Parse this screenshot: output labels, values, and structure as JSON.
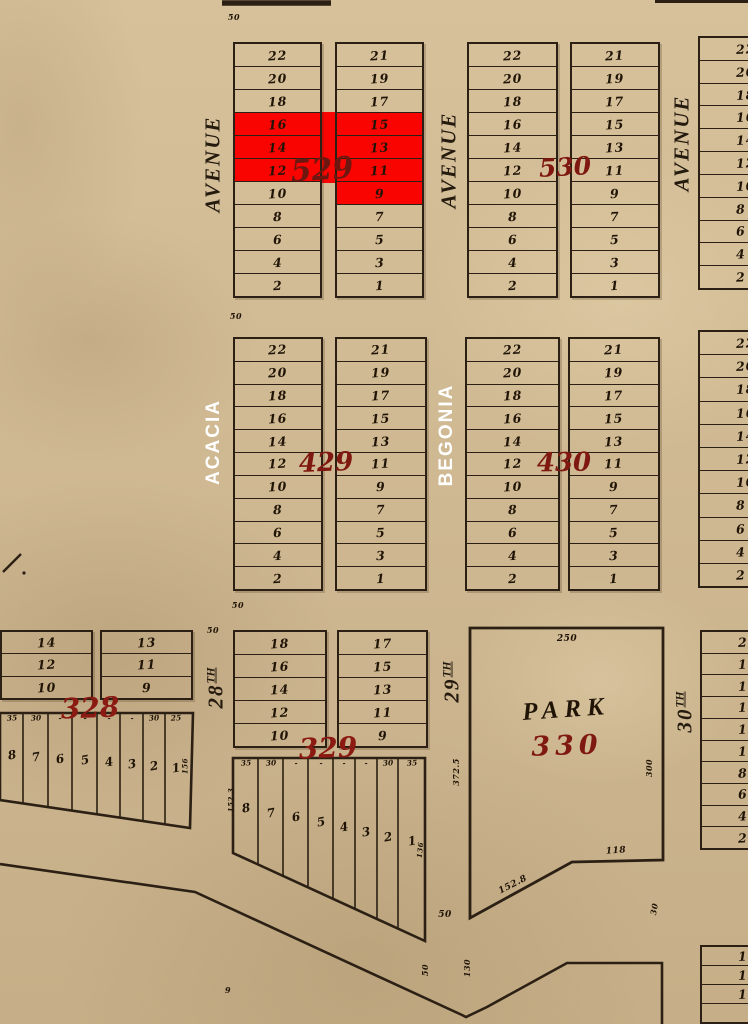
{
  "colors": {
    "background": "#d2bb93",
    "line": "#2b2013",
    "ink": "#201407",
    "highlight_red": "#f90400",
    "block_number_red": "#7e1810",
    "overlay_label_white": "#ffffff"
  },
  "blocks": {
    "b529": {
      "number": "529",
      "left_lots": [
        "22",
        "20",
        "18",
        "16",
        "14",
        "12",
        "10",
        "8",
        "6",
        "4",
        "2"
      ],
      "right_lots": [
        "21",
        "19",
        "17",
        "15",
        "13",
        "11",
        "9",
        "7",
        "5",
        "3",
        "1"
      ],
      "highlighted_left_lots": [
        "16",
        "14",
        "12"
      ],
      "highlighted_right_lots": [
        "15",
        "13",
        "11",
        "9"
      ]
    },
    "b530": {
      "number": "530",
      "left_lots": [
        "22",
        "20",
        "18",
        "16",
        "14",
        "12",
        "10",
        "8",
        "6",
        "4",
        "2"
      ],
      "right_lots": [
        "21",
        "19",
        "17",
        "15",
        "13",
        "11",
        "9",
        "7",
        "5",
        "3",
        "1"
      ],
      "highlighted_left_lots": [],
      "highlighted_right_lots": []
    },
    "b429": {
      "number": "429",
      "left_lots": [
        "22",
        "20",
        "18",
        "16",
        "14",
        "12",
        "10",
        "8",
        "6",
        "4",
        "2"
      ],
      "right_lots": [
        "21",
        "19",
        "17",
        "15",
        "13",
        "11",
        "9",
        "7",
        "5",
        "3",
        "1"
      ],
      "highlighted_left_lots": [],
      "highlighted_right_lots": []
    },
    "b430": {
      "number": "430",
      "left_lots": [
        "22",
        "20",
        "18",
        "16",
        "14",
        "12",
        "10",
        "8",
        "6",
        "4",
        "2"
      ],
      "right_lots": [
        "21",
        "19",
        "17",
        "15",
        "13",
        "11",
        "9",
        "7",
        "5",
        "3",
        "1"
      ],
      "highlighted_left_lots": [],
      "highlighted_right_lots": []
    },
    "b328": {
      "number": "328",
      "upper_left_lots": [
        "14",
        "12",
        "10"
      ],
      "upper_right_lots": [
        "13",
        "11",
        "9"
      ],
      "lower_lots": [
        "8",
        "7",
        "6",
        "5",
        "4",
        "3",
        "2",
        "1"
      ],
      "lower_dims": [
        "35",
        "30",
        "-",
        "-",
        "-",
        "-",
        "30",
        "25"
      ],
      "right_edge_dim": "156"
    },
    "b329": {
      "number": "329",
      "upper_left_lots": [
        "18",
        "16",
        "14",
        "12",
        "10"
      ],
      "upper_right_lots": [
        "17",
        "15",
        "13",
        "11",
        "9"
      ],
      "lower_lots": [
        "8",
        "7",
        "6",
        "5",
        "4",
        "3",
        "2",
        "1"
      ],
      "lower_dims": [
        "35",
        "30",
        "-",
        "-",
        "-",
        "-",
        "30",
        "35"
      ],
      "left_edge_dim": "152.3",
      "right_edge_dim": "136"
    },
    "b330": {
      "name": "PARK",
      "number": "330",
      "dim_top": "250",
      "dim_left": "372.5",
      "dim_right": "300",
      "dim_bottom": "118",
      "dim_diagonal": "152.8"
    },
    "partial_ne": {
      "lots": [
        "22",
        "20",
        "18",
        "16",
        "14",
        "12",
        "10",
        "8",
        "6",
        "4",
        "2"
      ]
    },
    "partial_e": {
      "lots": [
        "22",
        "20",
        "18",
        "16",
        "14",
        "12",
        "10",
        "8",
        "6",
        "4",
        "2"
      ]
    },
    "partial_se": {
      "lots": [
        "20",
        "18",
        "16",
        "14",
        "12",
        "10",
        "8",
        "6",
        "4",
        "2"
      ]
    },
    "partial_s": {
      "lots": [
        "14",
        "12",
        "10",
        ""
      ]
    }
  },
  "streets": {
    "avenue_nw": "AVENUE",
    "avenue_n": "AVENUE",
    "avenue_ne": "AVENUE",
    "acacia": "ACACIA",
    "begonia": "BEGONIA",
    "st28_base": "28",
    "st28_suffix": "TH",
    "st29_base": "29",
    "st29_suffix": "TH",
    "st30_base": "30",
    "st30_suffix": "TH"
  },
  "annotations": {
    "width_top": "50",
    "width_mid": "50",
    "width_lower": "50",
    "width_28th": "50",
    "width_29th": "50",
    "width_diag": "50",
    "dim_130": "130",
    "dim_30": "30",
    "small_9": "9"
  }
}
